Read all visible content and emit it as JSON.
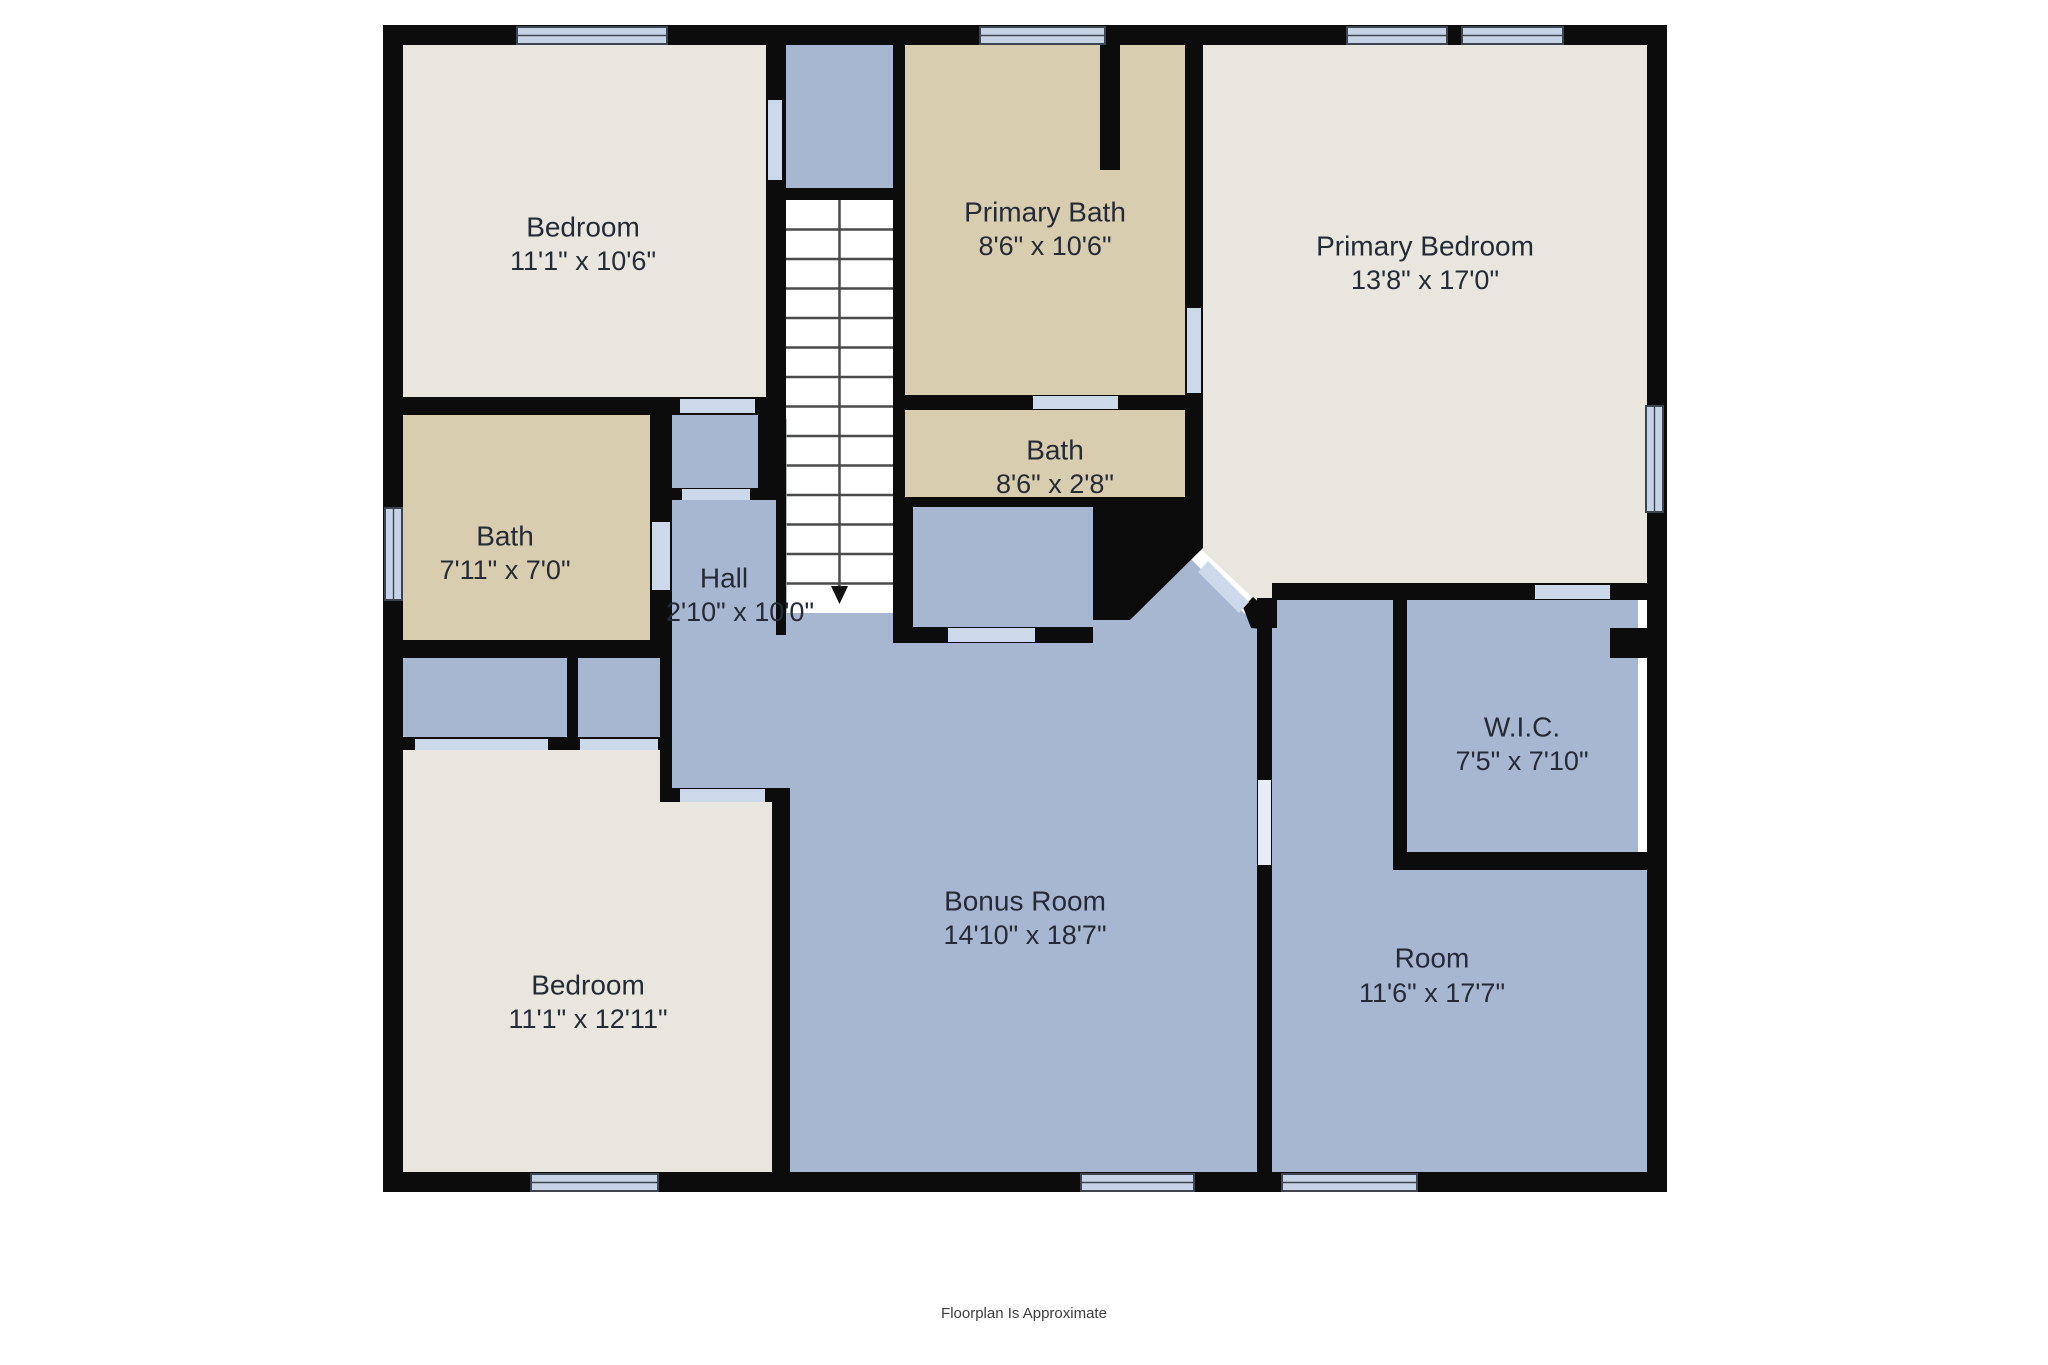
{
  "footer": {
    "label": "Floorplan Is Approximate",
    "x": 1024,
    "y": 1318,
    "font_size": 15
  },
  "colors": {
    "wall": "#0c0c0c",
    "cream_room": "#e8e6df",
    "tan_room": "#d9cdaf",
    "blue_room": "#a8b7d1",
    "window_fill": "#c6d3e6",
    "window_border": "#3e4450",
    "door_fill": "#ccd9ea",
    "passage_fill": "#e8edf5",
    "stairs_fill": "#ffffff",
    "tread_line": "#4a4a4a",
    "label_text": "#252b36"
  },
  "canvas": {
    "width": 2048,
    "height": 1365
  },
  "rooms": [
    {
      "id": "bedroom-top-left",
      "name": "Bedroom",
      "dims": "11'1\" x 10'6\"",
      "nx": 583,
      "ny": 229,
      "dx": 583,
      "dy": 263
    },
    {
      "id": "primary-bath",
      "name": "Primary Bath",
      "dims": "8'6\" x 10'6\"",
      "nx": 1045,
      "ny": 214,
      "dx": 1045,
      "dy": 248
    },
    {
      "id": "primary-bedroom",
      "name": "Primary Bedroom",
      "dims": "13'8\" x 17'0\"",
      "nx": 1425,
      "ny": 248,
      "dx": 1425,
      "dy": 282
    },
    {
      "id": "bath-small",
      "name": "Bath",
      "dims": "8'6\" x 2'8\"",
      "nx": 1055,
      "ny": 452,
      "dx": 1055,
      "dy": 486
    },
    {
      "id": "bath",
      "name": "Bath",
      "dims": "7'11\" x 7'0\"",
      "nx": 505,
      "ny": 538,
      "dx": 505,
      "dy": 572
    },
    {
      "id": "hall",
      "name": "Hall",
      "dims": "2'10\" x 10'0\"",
      "nx": 724,
      "ny": 580,
      "dx": 740,
      "dy": 614
    },
    {
      "id": "wic",
      "name": "W.I.C.",
      "dims": "7'5\" x 7'10\"",
      "nx": 1522,
      "ny": 729,
      "dx": 1522,
      "dy": 763
    },
    {
      "id": "bonus-room",
      "name": "Bonus Room",
      "dims": "14'10\" x 18'7\"",
      "nx": 1025,
      "ny": 903,
      "dx": 1025,
      "dy": 937
    },
    {
      "id": "bedroom-bottom-left",
      "name": "Bedroom",
      "dims": "11'1\" x 12'11\"",
      "nx": 588,
      "ny": 987,
      "dx": 588,
      "dy": 1021
    },
    {
      "id": "room",
      "name": "Room",
      "dims": "11'6\" x 17'7\"",
      "nx": 1432,
      "ny": 960,
      "dx": 1432,
      "dy": 995
    }
  ],
  "label_font_size": 28,
  "floors": [
    {
      "name": "floor-bedroom-top-left",
      "fill": "cream_room",
      "rect": [
        403,
        45,
        363,
        352
      ]
    },
    {
      "name": "floor-bedroom-bottom-left",
      "fill": "cream_room",
      "poly": [
        [
          403,
          750
        ],
        [
          660,
          750
        ],
        [
          660,
          802
        ],
        [
          772,
          802
        ],
        [
          772,
          1172
        ],
        [
          403,
          1172
        ]
      ]
    },
    {
      "name": "floor-primary-bedroom",
      "fill": "cream_room",
      "poly": [
        [
          1203,
          45
        ],
        [
          1647,
          45
        ],
        [
          1647,
          583
        ],
        [
          1290,
          583
        ],
        [
          1290,
          600
        ],
        [
          1272,
          618
        ],
        [
          1253,
          598
        ],
        [
          1203,
          551
        ]
      ]
    },
    {
      "name": "floor-bath",
      "fill": "tan_room",
      "rect": [
        403,
        415,
        247,
        225
      ]
    },
    {
      "name": "floor-primary-bath",
      "fill": "tan_room",
      "rect": [
        905,
        45,
        280,
        350
      ]
    },
    {
      "name": "floor-bath-small",
      "fill": "tan_room",
      "rect": [
        905,
        410,
        280,
        87
      ]
    },
    {
      "name": "floor-vestibule-closet",
      "fill": "blue_room",
      "rect": [
        672,
        415,
        86,
        73
      ]
    },
    {
      "name": "floor-hall",
      "fill": "blue_room",
      "rect": [
        672,
        500,
        104,
        288
      ]
    },
    {
      "name": "floor-stair-landing",
      "fill": "blue_room",
      "rect": [
        786,
        45,
        107,
        143
      ]
    },
    {
      "name": "floor-closet-a",
      "fill": "blue_room",
      "rect": [
        403,
        658,
        164,
        79
      ]
    },
    {
      "name": "floor-closet-b",
      "fill": "blue_room",
      "rect": [
        578,
        658,
        82,
        79
      ]
    },
    {
      "name": "floor-alcove-closet",
      "fill": "blue_room",
      "rect": [
        913,
        507,
        180,
        120
      ]
    },
    {
      "name": "floor-wic",
      "fill": "blue_room",
      "rect": [
        1407,
        600,
        231,
        252
      ]
    },
    {
      "name": "floor-room-upper",
      "fill": "blue_room",
      "rect": [
        1272,
        600,
        121,
        270
      ]
    },
    {
      "name": "floor-room-lower",
      "fill": "blue_room",
      "rect": [
        1272,
        870,
        375,
        302
      ]
    },
    {
      "name": "floor-bonus-room",
      "fill": "blue_room",
      "poly": [
        [
          776,
          613
        ],
        [
          893,
          613
        ],
        [
          893,
          643
        ],
        [
          905,
          643
        ],
        [
          1093,
          643
        ],
        [
          1093,
          620
        ],
        [
          1130,
          620
        ],
        [
          1190,
          558
        ],
        [
          1243,
          612
        ],
        [
          1257,
          625
        ],
        [
          1257,
          1172
        ],
        [
          790,
          1172
        ],
        [
          790,
          802
        ],
        [
          776,
          802
        ]
      ]
    }
  ],
  "stairs": {
    "well": [
      786,
      200,
      107,
      413
    ],
    "tread_count": 13,
    "center_x": 839.5,
    "open_edge": [
      777,
      420,
      9,
      192
    ],
    "arrow": [
      [
        831,
        586
      ],
      [
        848,
        586
      ],
      [
        839.5,
        604
      ]
    ]
  },
  "walls": [
    {
      "name": "wall-outer-top",
      "rect": [
        383,
        25,
        1284,
        20
      ]
    },
    {
      "name": "wall-outer-bottom",
      "rect": [
        383,
        1172,
        1284,
        20
      ]
    },
    {
      "name": "wall-outer-left",
      "rect": [
        383,
        25,
        20,
        1167
      ]
    },
    {
      "name": "wall-outer-right",
      "rect": [
        1647,
        25,
        20,
        1167
      ]
    },
    {
      "name": "wall-bedroomtl-bottom",
      "rect": [
        383,
        397,
        403,
        18
      ]
    },
    {
      "name": "wall-bedroomtl-right",
      "rect": [
        766,
        45,
        20,
        370
      ]
    },
    {
      "name": "wall-vestibule-right",
      "rect": [
        758,
        415,
        18,
        85
      ]
    },
    {
      "name": "wall-bath-right",
      "rect": [
        650,
        415,
        22,
        225
      ]
    },
    {
      "name": "wall-vestibule-bottom",
      "rect": [
        655,
        488,
        121,
        12
      ]
    },
    {
      "name": "wall-stairs-left-thin",
      "rect": [
        776,
        415,
        10,
        220
      ]
    },
    {
      "name": "wall-bath-bottom",
      "rect": [
        383,
        640,
        289,
        18
      ]
    },
    {
      "name": "wall-closets-divider",
      "rect": [
        567,
        658,
        11,
        79
      ]
    },
    {
      "name": "wall-closets-right",
      "rect": [
        660,
        658,
        12,
        144
      ]
    },
    {
      "name": "wall-closets-bottom",
      "rect": [
        383,
        737,
        289,
        13
      ]
    },
    {
      "name": "wall-hall-bottom",
      "rect": [
        672,
        788,
        118,
        14
      ]
    },
    {
      "name": "wall-bedroombl-right",
      "rect": [
        772,
        802,
        18,
        370
      ]
    },
    {
      "name": "wall-landing-separator",
      "rect": [
        786,
        188,
        107,
        12
      ]
    },
    {
      "name": "wall-stairs-right",
      "rect": [
        893,
        45,
        12,
        598
      ]
    },
    {
      "name": "wall-primarybath-stub",
      "rect": [
        1100,
        45,
        20,
        125
      ]
    },
    {
      "name": "wall-primarybath-bottom",
      "rect": [
        895,
        395,
        308,
        15
      ]
    },
    {
      "name": "wall-primarybath-right",
      "rect": [
        1185,
        45,
        18,
        462
      ]
    },
    {
      "name": "wall-bathsmall-bottom",
      "rect": [
        895,
        497,
        308,
        10
      ]
    },
    {
      "name": "wall-alcove-left",
      "rect": [
        902,
        507,
        11,
        136
      ]
    },
    {
      "name": "wall-alcove-bottom",
      "rect": [
        902,
        627,
        191,
        16
      ]
    },
    {
      "name": "wall-primarybed-bottom",
      "rect": [
        1272,
        583,
        395,
        17
      ]
    },
    {
      "name": "wall-room-left",
      "rect": [
        1257,
        618,
        15,
        554
      ]
    },
    {
      "name": "wall-room-left-join",
      "rect": [
        1257,
        598,
        20,
        30
      ]
    },
    {
      "name": "wall-wic-left",
      "rect": [
        1393,
        583,
        14,
        287
      ]
    },
    {
      "name": "wall-wic-bottom",
      "rect": [
        1393,
        852,
        255,
        18
      ]
    },
    {
      "name": "wall-wic-notch",
      "rect": [
        1610,
        628,
        38,
        30
      ]
    },
    {
      "name": "wall-void-corner",
      "poly": [
        [
          1093,
          507
        ],
        [
          1203,
          507
        ],
        [
          1203,
          548
        ],
        [
          1130,
          620
        ],
        [
          1093,
          620
        ]
      ]
    },
    {
      "name": "wall-diagonal-lower",
      "poly": [
        [
          1243,
          607
        ],
        [
          1253,
          597
        ],
        [
          1272,
          614
        ],
        [
          1272,
          630
        ],
        [
          1251,
          628
        ]
      ]
    }
  ],
  "windows": [
    {
      "name": "window-top-bedroom",
      "rect": [
        517,
        27,
        150,
        17
      ],
      "dir": "h"
    },
    {
      "name": "window-top-primary-bath",
      "rect": [
        980,
        27,
        125,
        17
      ],
      "dir": "h"
    },
    {
      "name": "window-top-primary-bed-1",
      "rect": [
        1347,
        27,
        100,
        17
      ],
      "dir": "h"
    },
    {
      "name": "window-top-primary-bed-2",
      "rect": [
        1462,
        27,
        101,
        17
      ],
      "dir": "h"
    },
    {
      "name": "window-left-bath",
      "rect": [
        385,
        508,
        17,
        92
      ],
      "dir": "v"
    },
    {
      "name": "window-right-primary-bed",
      "rect": [
        1646,
        406,
        17,
        106
      ],
      "dir": "v"
    },
    {
      "name": "window-bottom-bedroom",
      "rect": [
        531,
        1174,
        127,
        17
      ],
      "dir": "h"
    },
    {
      "name": "window-bottom-bonus",
      "rect": [
        1081,
        1174,
        113,
        17
      ],
      "dir": "h"
    },
    {
      "name": "window-bottom-room",
      "rect": [
        1282,
        1174,
        135,
        17
      ],
      "dir": "h"
    }
  ],
  "doors": [
    {
      "name": "door-bedroomtl-vestibule",
      "rect": [
        680,
        399,
        75,
        14
      ]
    },
    {
      "name": "door-vestibule-hall",
      "rect": [
        682,
        489,
        68,
        11
      ]
    },
    {
      "name": "door-bedroomtl-landing",
      "rect": [
        768,
        100,
        14,
        80
      ]
    },
    {
      "name": "door-bath",
      "rect": [
        652,
        522,
        18,
        68
      ]
    },
    {
      "name": "door-closet-a",
      "rect": [
        415,
        739,
        133,
        11
      ]
    },
    {
      "name": "door-closet-b",
      "rect": [
        580,
        739,
        78,
        11
      ]
    },
    {
      "name": "door-bedroombl",
      "rect": [
        680,
        789,
        85,
        13
      ]
    },
    {
      "name": "door-primarybath-south",
      "rect": [
        1033,
        396,
        85,
        13
      ]
    },
    {
      "name": "door-primarybath-east",
      "rect": [
        1187,
        308,
        14,
        85
      ]
    },
    {
      "name": "door-alcove",
      "rect": [
        948,
        628,
        87,
        14
      ]
    },
    {
      "name": "door-wic",
      "rect": [
        1535,
        585,
        75,
        14
      ]
    },
    {
      "name": "door-diagonal-primary-bed",
      "poly": [
        [
          1198,
          572
        ],
        [
          1208,
          561
        ],
        [
          1249,
          602
        ],
        [
          1239,
          613
        ]
      ]
    },
    {
      "name": "door-bonus-room-passage",
      "rect": [
        1258,
        780,
        13,
        85
      ],
      "passage": true
    }
  ]
}
